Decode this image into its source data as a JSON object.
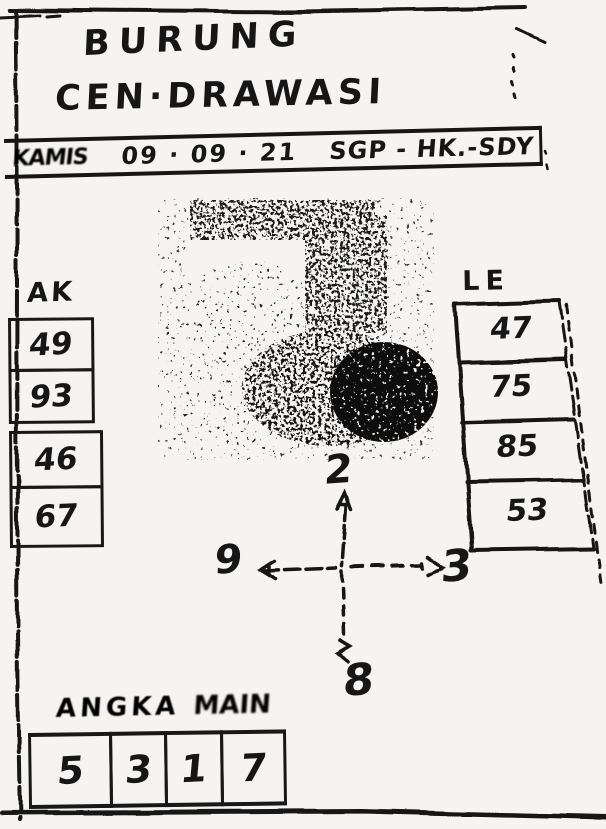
{
  "colors": {
    "ink": "#161616",
    "paper": "#f5f4f2"
  },
  "title": {
    "line1": "BURUNG",
    "line2": "CEN·DRAWASI"
  },
  "banner": {
    "day": "KAMIS",
    "date": "09 · 09 · 21",
    "markets": "SGP - HK.-SDY"
  },
  "ak": {
    "label": "AK",
    "values": [
      "49",
      "93",
      "46",
      "67"
    ]
  },
  "le": {
    "label": "LE",
    "values": [
      "47",
      "75",
      "85",
      "53"
    ]
  },
  "compass": {
    "top": "2",
    "left": "9",
    "right": "3",
    "bottom": "8"
  },
  "angka_main": {
    "word1": "ANGKA",
    "word2": "MAIN",
    "digits": [
      "5",
      "3",
      "1",
      "7"
    ]
  }
}
